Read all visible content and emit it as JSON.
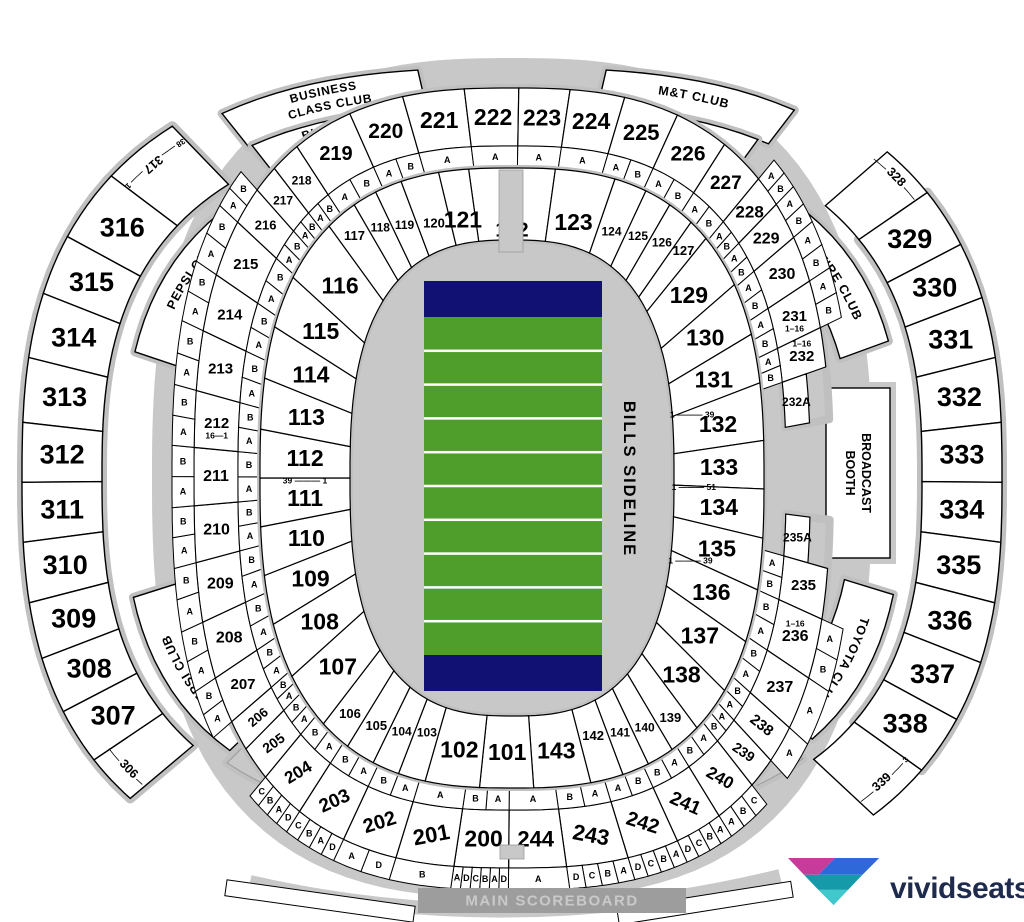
{
  "field": {
    "label": "BILLS SIDELINE",
    "grass_color": "#4f9e2c",
    "endzone_color": "#101173",
    "stripe_count": 10
  },
  "lower_ring": {
    "sections": [
      "122",
      "123",
      "124",
      "125",
      "126",
      "127",
      "129",
      "130",
      "131",
      "132",
      "133",
      "134",
      "135",
      "136",
      "137",
      "138",
      "139",
      "140",
      "141",
      "142",
      "143",
      "101",
      "102",
      "103",
      "104",
      "105",
      "106",
      "107",
      "108",
      "109",
      "110",
      "111",
      "112",
      "113",
      "114",
      "115",
      "116",
      "117",
      "118",
      "119",
      "120",
      "121"
    ]
  },
  "mid_ring": {
    "sections": [
      "219",
      "220",
      "221",
      "222",
      "223",
      "224",
      "225",
      "226",
      "227",
      "228",
      "229",
      "230",
      "231",
      "232",
      "232A",
      "235A",
      "235",
      "236",
      "237",
      "238",
      "239",
      "240",
      "241",
      "242",
      "243",
      "244",
      "200",
      "201",
      "202",
      "203",
      "204",
      "205",
      "206",
      "207",
      "208",
      "209",
      "210",
      "211",
      "212",
      "213",
      "214",
      "215",
      "216",
      "217",
      "218"
    ]
  },
  "upper_left": [
    "317",
    "316",
    "315",
    "314",
    "313",
    "312",
    "311",
    "310",
    "309",
    "308",
    "307",
    "306"
  ],
  "upper_right": [
    "328",
    "329",
    "330",
    "331",
    "332",
    "333",
    "334",
    "335",
    "336",
    "337",
    "338",
    "339"
  ],
  "wing_rows": {
    "317": [
      "38",
      "1"
    ],
    "306": [
      "38",
      "1"
    ],
    "328": [
      "1",
      "38"
    ],
    "339": [
      "1",
      "38"
    ]
  },
  "row_notes": {
    "111": "39 ——— 1",
    "132": "1 ——— 39",
    "134": "1 ——— 51",
    "136": "1 ——— 39",
    "212": "16—1",
    "231": "1–16",
    "232": "1–16",
    "236": "1–16"
  },
  "letters": {
    "inner": {
      "216": [
        "B",
        "A"
      ],
      "217": [
        "B",
        "A"
      ],
      "218": [
        "B",
        "A"
      ],
      "219": [
        "B",
        "A"
      ],
      "220": [
        "B",
        "A"
      ],
      "221": [
        "A"
      ],
      "222": [
        "A"
      ],
      "223": [
        "A"
      ],
      "224": [
        "A"
      ],
      "225": [
        "A",
        "B"
      ],
      "226": [
        "A",
        "B"
      ],
      "227": [
        "A",
        "B"
      ],
      "228": [
        "A",
        "B"
      ],
      "229": [
        "A",
        "B"
      ],
      "230": [
        "A",
        "B"
      ],
      "231": [
        "A",
        "B"
      ],
      "232": [
        "A",
        "B"
      ],
      "235": [
        "A",
        "B"
      ],
      "236": [
        "B",
        "A"
      ],
      "237": [
        "B",
        "A"
      ],
      "238": [
        "B",
        "A"
      ],
      "239": [
        "B",
        "A"
      ],
      "240": [
        "B",
        "A"
      ],
      "241": [
        "B",
        "A"
      ],
      "242": [
        "A",
        "B"
      ],
      "243": [
        "B",
        "A"
      ],
      "244": [
        "A"
      ],
      "200": [
        "B",
        "A"
      ],
      "201": [
        "A"
      ],
      "202": [
        "B",
        "A"
      ],
      "203": [
        "B",
        "A"
      ],
      "204": [
        "B",
        "A"
      ],
      "205": [
        "B",
        "A"
      ],
      "206": [
        "B",
        "A"
      ],
      "207": [
        "B",
        "A"
      ],
      "208": [
        "B",
        "A"
      ],
      "209": [
        "B",
        "A"
      ],
      "210": [
        "B",
        "A"
      ],
      "211": [
        "B",
        "A"
      ],
      "212": [
        "B",
        "A"
      ],
      "213": [
        "B",
        "A"
      ],
      "214": [
        "B",
        "A"
      ],
      "215": [
        "B",
        "A"
      ]
    },
    "outer": {
      "207": [
        "B",
        "A"
      ],
      "208": [
        "B",
        "A"
      ],
      "209": [
        "B",
        "A"
      ],
      "210": [
        "B",
        "A"
      ],
      "211": [
        "B",
        "A"
      ],
      "212": [
        "B",
        "A"
      ],
      "213": [
        "B",
        "A"
      ],
      "214": [
        "B",
        "A"
      ],
      "215": [
        "B",
        "A"
      ],
      "216": [
        "B",
        "A"
      ],
      "228": [
        "A",
        "B"
      ],
      "229": [
        "A",
        "B"
      ],
      "230": [
        "A",
        "B"
      ],
      "231": [
        "A",
        "B"
      ],
      "236": [
        "A",
        "B"
      ],
      "237": [
        "A"
      ],
      "238": [
        "A"
      ],
      "240": [
        "A",
        "B",
        "C"
      ],
      "241": [
        "D",
        "C",
        "B",
        "A"
      ],
      "242": [
        "D",
        "C",
        "B",
        "A"
      ],
      "243": [
        "D",
        "C",
        "B",
        "A"
      ],
      "244": [
        "A"
      ],
      "200": [
        "A",
        "D",
        "C",
        "B",
        "A",
        "D"
      ],
      "201": [
        "B"
      ],
      "202": [
        "A",
        "D"
      ],
      "203": [
        "C",
        "B",
        "A",
        "D"
      ],
      "204": [
        "C",
        "B",
        "A",
        "D"
      ]
    }
  },
  "clubs": [
    {
      "id": "business-class-club",
      "label": "BUSINESS CLASS CLUB"
    },
    {
      "id": "bud-light-club",
      "label": "BUD LIGHT CLUB"
    },
    {
      "id": "mt-club",
      "label": "M&T CLUB"
    },
    {
      "id": "press-box",
      "label": "PRESS BOX"
    },
    {
      "id": "pepsi-club-upper",
      "label": "PEPSI CLUB"
    },
    {
      "id": "pepsi-club-lower",
      "label": "PEPSI CLUB"
    },
    {
      "id": "dunn-tire-club",
      "label": "DUNN TIRE CLUB"
    },
    {
      "id": "broadcast-booth",
      "label": "BROADCAST BOOTH"
    },
    {
      "id": "toyota-club",
      "label": "TOYOTA CLUB"
    },
    {
      "id": "west-end-suites-left",
      "label": "WEST END SUITES"
    },
    {
      "id": "west-end-suites-right",
      "label": "WEST END SUITES"
    }
  ],
  "scoreboard": {
    "label": "MAIN SCOREBOARD"
  },
  "logo": {
    "text": "vividseats",
    "text_color": "#1f2b4d",
    "mark_colors": {
      "pink": "#c73b9b",
      "blue": "#2e68d9",
      "teal": "#149aa8",
      "aqua": "#41c8cd"
    }
  },
  "colors": {
    "outline_gray": "#c8c8c8",
    "cell_fill": "#ffffff",
    "stroke": "#000000",
    "scoreboard_bar": "#9d9d9d",
    "scoreboard_text": "#c9c9c9"
  }
}
